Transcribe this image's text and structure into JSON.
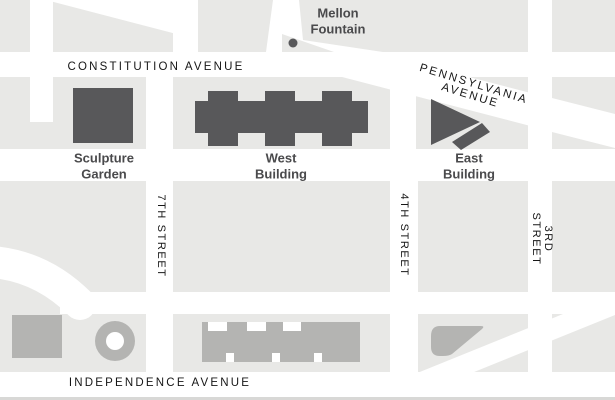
{
  "map": {
    "title": "National Gallery of Art area map",
    "streets": {
      "constitution": "CONSTITUTION AVENUE",
      "pennsylvania": "PENNSYLVANIA AVENUE",
      "independence": "INDEPENDENCE AVENUE",
      "seventh": "7TH STREET",
      "fourth": "4TH STREET",
      "third": "3RD STREET"
    },
    "places": {
      "mellon_fountain": "Mellon\nFountain",
      "sculpture_garden": "Sculpture\nGarden",
      "west_building": "West\nBuilding",
      "east_building": "East\nBuilding"
    },
    "colors": {
      "block_gray": "#e8e8e6",
      "street_white": "#ffffff",
      "building_dark": "#58585a",
      "building_light": "#b4b4b2",
      "place_label": "#4a4a4c",
      "street_label": "#161616",
      "bottom_border": "#d8d8d6"
    }
  }
}
